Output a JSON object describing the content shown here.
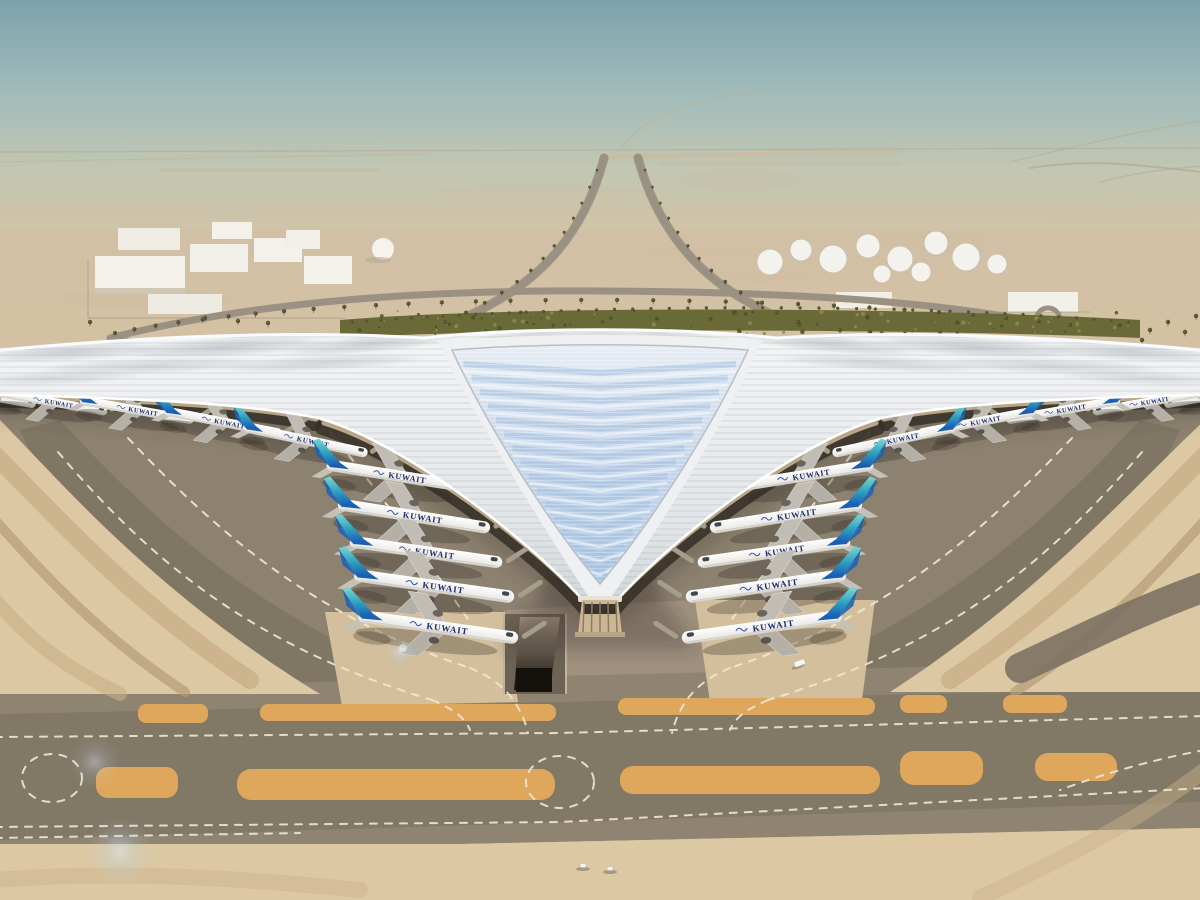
{
  "airline": {
    "label": "KUWAIT",
    "label_color": "#1d2b6e",
    "tail_top": "#6fd8ce",
    "tail_bottom": "#1a5fb4"
  },
  "palette": {
    "sky_top": "#7da2ac",
    "sky_mid": "#a9c0bb",
    "horizon_haze": "#d0c3a7",
    "desert": "#d6c3a3",
    "sand": "#dcc8a2",
    "apron": "#8d8270",
    "apron_light": "#a29480",
    "asphalt_dark": "#7a7160",
    "taxiway": "#8e8471",
    "marking_white": "#efe7d3",
    "shoulder_orange": "#dea75c",
    "roof_white": "#f2f3f4",
    "roof_silver": "#aab4bc",
    "glass_light": "#e9eff6",
    "glass_blue": "#a3c0e0",
    "facade_tan": "#c7b291",
    "terminal_shadow": "#3a332a",
    "landscape_green": "#6a6a38",
    "palm_green": "#4f4d2a",
    "building_white": "#f3f1ea",
    "road_gray": "#978e80",
    "fuselage_white": "#f7f8f7",
    "wing_gray": "#b5b0a7"
  },
  "planes": {
    "label": "KUWAIT",
    "placements": [
      {
        "x": -18,
        "y": 395,
        "r": 10,
        "s": 0.7,
        "flip": false
      },
      {
        "x": 52,
        "y": 402,
        "r": 10,
        "s": 0.72,
        "flip": false
      },
      {
        "x": 136,
        "y": 410,
        "r": 10,
        "s": 0.75,
        "flip": false
      },
      {
        "x": 222,
        "y": 422,
        "r": 11,
        "s": 0.78,
        "flip": false
      },
      {
        "x": 305,
        "y": 440,
        "r": 12,
        "s": 0.82,
        "flip": false
      },
      {
        "x": 398,
        "y": 476,
        "r": 9,
        "s": 0.95,
        "flip": false
      },
      {
        "x": 413,
        "y": 516,
        "r": 9,
        "s": 1.0,
        "flip": false
      },
      {
        "x": 425,
        "y": 552,
        "r": 8,
        "s": 1.0,
        "flip": false
      },
      {
        "x": 433,
        "y": 586,
        "r": 8,
        "s": 1.05,
        "flip": false
      },
      {
        "x": 437,
        "y": 627,
        "r": 8,
        "s": 1.05,
        "flip": false
      },
      {
        "x": 1218,
        "y": 395,
        "r": -10,
        "s": 0.7,
        "flip": true
      },
      {
        "x": 1148,
        "y": 402,
        "r": -10,
        "s": 0.72,
        "flip": true
      },
      {
        "x": 1064,
        "y": 410,
        "r": -10,
        "s": 0.75,
        "flip": true
      },
      {
        "x": 978,
        "y": 422,
        "r": -11,
        "s": 0.78,
        "flip": true
      },
      {
        "x": 895,
        "y": 440,
        "r": -12,
        "s": 0.82,
        "flip": true
      },
      {
        "x": 802,
        "y": 476,
        "r": -9,
        "s": 0.95,
        "flip": true
      },
      {
        "x": 787,
        "y": 516,
        "r": -9,
        "s": 1.0,
        "flip": true
      },
      {
        "x": 775,
        "y": 552,
        "r": -8,
        "s": 1.0,
        "flip": true
      },
      {
        "x": 767,
        "y": 586,
        "r": -8,
        "s": 1.05,
        "flip": true
      },
      {
        "x": 763,
        "y": 627,
        "r": -8,
        "s": 1.05,
        "flip": true
      }
    ]
  },
  "vehicles": [
    {
      "x": 799,
      "y": 663,
      "r": -20
    },
    {
      "x": 585,
      "y": 866,
      "r": 0
    },
    {
      "x": 612,
      "y": 869,
      "r": 0
    }
  ],
  "counts": {
    "aircraft_visible": 20,
    "vehicles_visible": 3
  }
}
